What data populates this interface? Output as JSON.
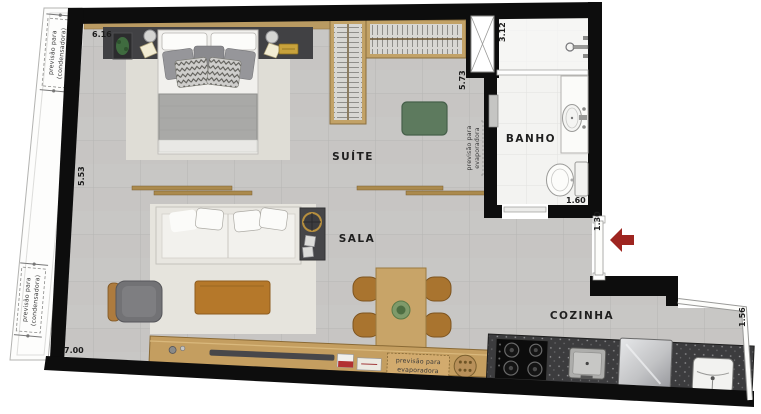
{
  "rooms": {
    "suite": "SUÍTE",
    "sala": "SALA",
    "banho": "BANHO",
    "cozinha": "COZINHA"
  },
  "dimensions": {
    "top_width": "6.16",
    "left_height": "5.53",
    "bottom_width": "7.00",
    "closet_wall": "5.73",
    "shower_wall": "3.12",
    "bath_width": "1.60",
    "entry_door": "1.30",
    "kitchen_side": "1.56"
  },
  "notes": {
    "prevision": "previsão para",
    "condenser": "(condensadora)",
    "evaporator": "evaporadora"
  },
  "colors": {
    "wall": "#0d0d0d",
    "floor_tile": "#c8c7c5",
    "bath_tile": "#f3f3f1",
    "wood": "#c49e60",
    "counter_dark": "#3c3c3e",
    "pouf_green": "#5d7a5e",
    "entry_arrow_red": "#9e2520",
    "headboard": "#414144"
  }
}
